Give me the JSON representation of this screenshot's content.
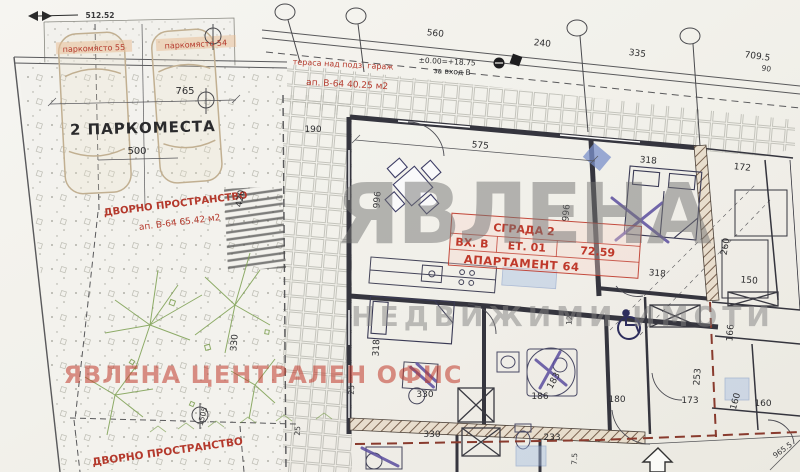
{
  "survey": {
    "elevation": "512.52"
  },
  "parking": {
    "space_a": "паркомясто 55",
    "space_b": "паркомясто 54",
    "title": "2 ПАРКОМЕСТА",
    "dim_length": "765",
    "dim_width": "500"
  },
  "yard": {
    "label_top": "ДВОРНО ПРОСТРАНСТВО",
    "area_top": "ап. В-64 65.42 м2",
    "label_bottom": "ДВОРНО ПРОСТРАНСТВО"
  },
  "terrace": {
    "label": "тераса над подз. гараж",
    "area": "ап. В-64 40.25 м2"
  },
  "apartment": {
    "building": "СГРАДА 2",
    "entrance": "ВХ. В",
    "floor": "ЕТ. 01",
    "area_m2": "72.59",
    "unit": "АПАРТАМЕНТ 64",
    "level_note": "±0.00=+18.75",
    "level_for": "за вход В"
  },
  "watermark": {
    "logo": "ЯВЛЕНА",
    "tagline": "НЕДВИЖИМИ ИМОТИ",
    "office": "ЯВЛЕНА ЦЕНТРАЛЕН ОФИС"
  },
  "dims": {
    "d190": "190",
    "d575": "575",
    "d560": "560",
    "d240": "240",
    "d335": "335",
    "d709": "709.5",
    "d90": "90",
    "d996a": "996",
    "d996b": "996",
    "d318a": "318",
    "d318b": "318",
    "d318c": "318",
    "d330a": "330",
    "d330b": "330",
    "d330c": "330",
    "d420": "420",
    "d1505": "1505",
    "d172": "172",
    "d150": "150",
    "d125": "125",
    "d253": "253",
    "d260": "260",
    "d233": "233",
    "d166": "166",
    "d186": "186",
    "d183": "183",
    "d180": "180",
    "d173": "173",
    "d160a": "160",
    "d160b": "160",
    "d25a": "25",
    "d25b": "25",
    "d75": "7.5",
    "d9655": "965.5"
  },
  "colors": {
    "red_label": "#b5392c",
    "watermark_gray": "#808080",
    "tree_green": "#7da051",
    "wall_dark": "#35353e",
    "boundary_red": "#8a3b2e"
  }
}
